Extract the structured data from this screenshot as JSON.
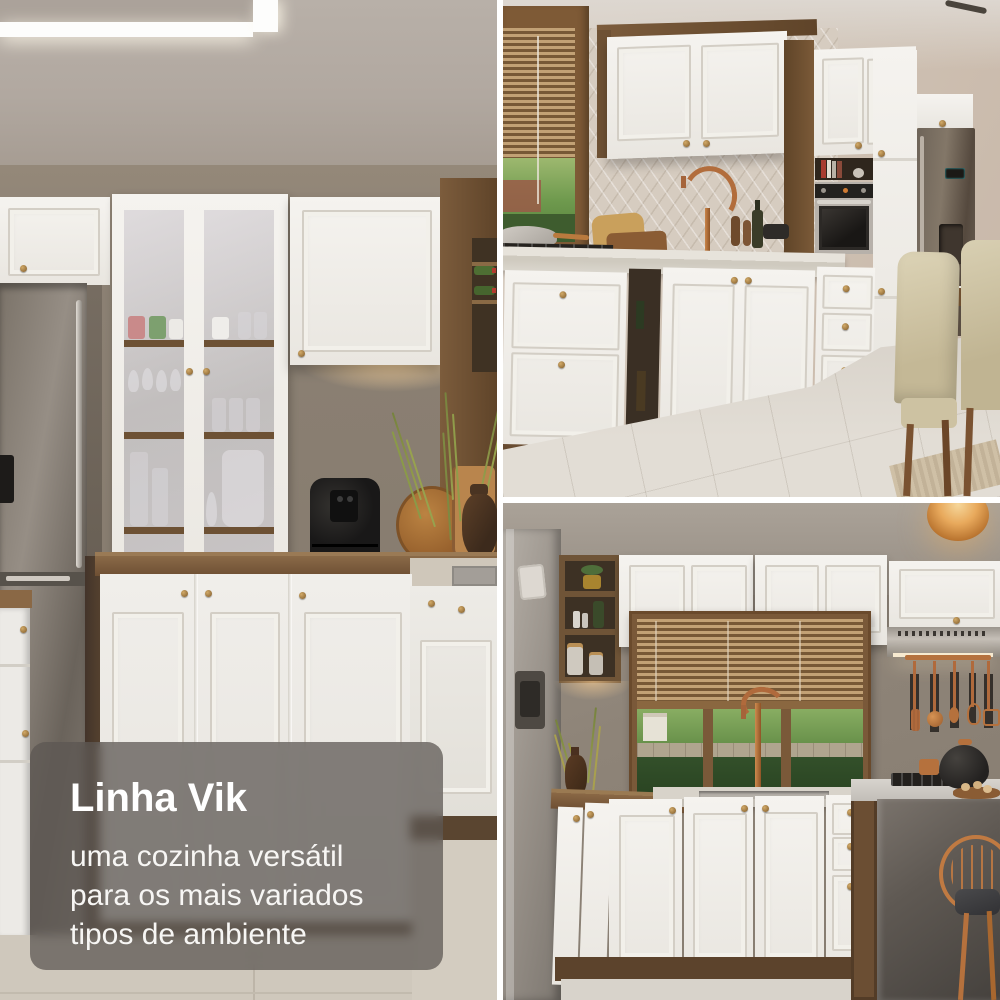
{
  "overlay": {
    "title": "Linha Vik",
    "subtitle_lines": [
      "uma cozinha versátil",
      "para os mais variados",
      "tipos de ambiente"
    ]
  },
  "theme": {
    "gutter_color": "#ffffff",
    "overlay_bg": "rgba(92,87,82,0.74)",
    "overlay_text_color": "#ffffff",
    "cabinet_white": "#f1efeb",
    "accent_wood": "#7c5c3c",
    "accent_brass": "#a07b3e",
    "accent_copper": "#b26d3c"
  }
}
